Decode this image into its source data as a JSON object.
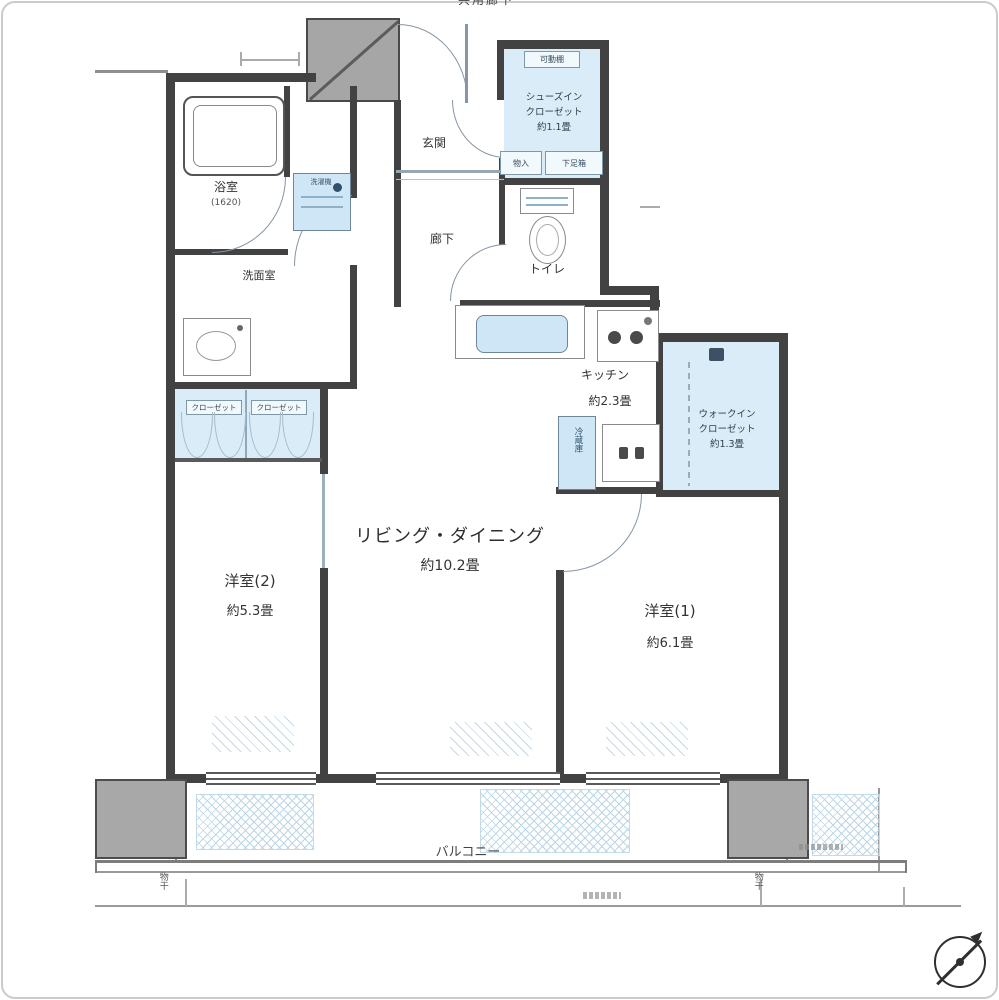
{
  "plan": {
    "kind": "floorplan"
  },
  "labels": {
    "common_corridor": "共用廊下",
    "entrance": "玄関",
    "hallway": "廊下",
    "toilet": "トイレ",
    "washroom": "洗面室",
    "bathroom": "浴室",
    "bathroom_size": "(1620)",
    "washer": "洗濯機",
    "kitchen": "キッチン",
    "kitchen_size": "約2.3畳",
    "living_dining": "リビング・ダイニング",
    "living_dining_size": "約10.2畳",
    "bedroom2": "洋室(2)",
    "bedroom2_size": "約5.3畳",
    "bedroom1": "洋室(1)",
    "bedroom1_size": "約6.1畳",
    "balcony": "バルコニー",
    "shoes_closet_line1": "シューズイン",
    "shoes_closet_line2": "クローゼット",
    "shoes_closet_size": "約1.1畳",
    "walkin_closet_line1": "ウォークイン",
    "walkin_closet_line2": "クローゼット",
    "walkin_closet_size": "約1.3畳",
    "closet_left": "クローゼット",
    "closet_right": "クローゼット",
    "movable_shelf": "可動棚",
    "storage": "物入",
    "shoe_box": "下足箱",
    "refrigerator": "冷蔵庫",
    "laundry_pole_left": "物干",
    "laundry_pole_right": "物干"
  },
  "colors": {
    "wall": "#424242",
    "closet_fill": "#d9ecf8",
    "fixture_fill": "#cfe6f6",
    "hatch_line": "#bcd6e6",
    "column_fill": "#a8a8a8",
    "door_arc": "#8796a4",
    "frame_border": "#cbcbcb"
  }
}
